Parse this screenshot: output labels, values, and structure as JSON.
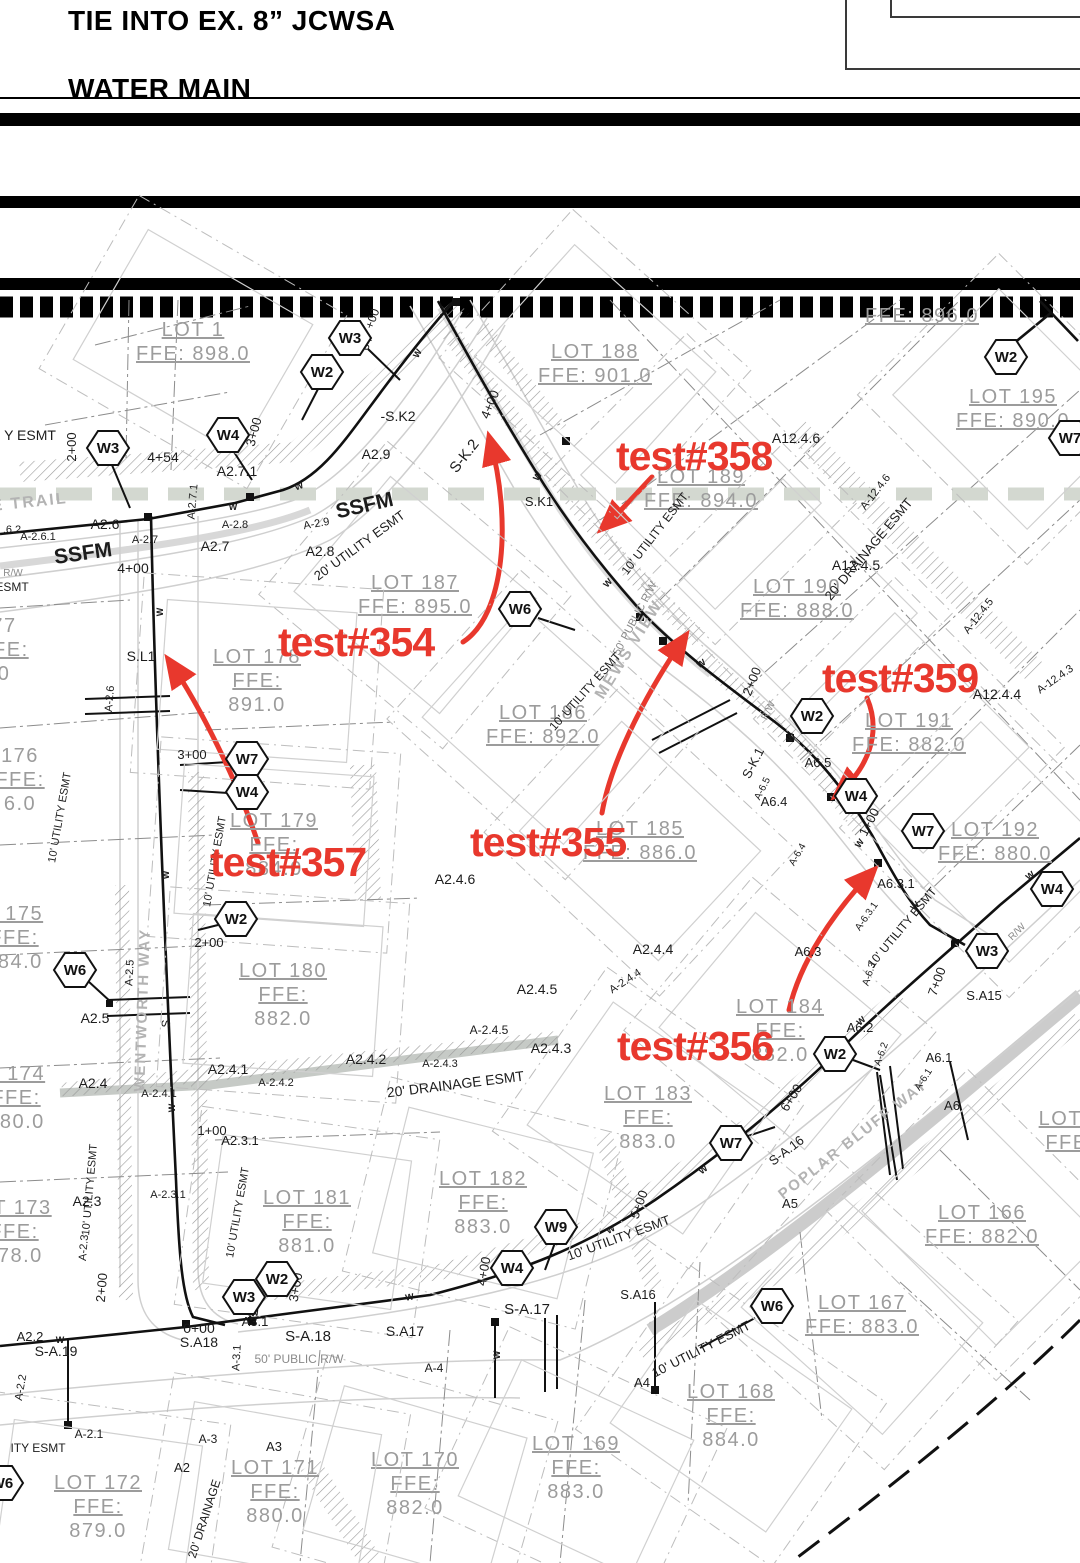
{
  "header": {
    "line1": "TIE INTO EX. 8” JCWSA",
    "line2": "WATER MAIN"
  },
  "colors": {
    "red": "#e8382d",
    "lot": "#9c9c9c",
    "street": "#b3b3b3",
    "rw": "#8a8a8a",
    "ink": "#1c1c1c",
    "band": "#d3d8d0"
  },
  "annotations": [
    {
      "label": "test#354",
      "x": 278,
      "y": 656
    },
    {
      "label": "test#355",
      "x": 470,
      "y": 856
    },
    {
      "label": "test#356",
      "x": 617,
      "y": 1060
    },
    {
      "label": "test#357",
      "x": 210,
      "y": 876
    },
    {
      "label": "test#358",
      "x": 616,
      "y": 470
    },
    {
      "label": "test#359",
      "x": 822,
      "y": 692
    }
  ],
  "hexes": [
    {
      "label": "W3",
      "x": 350,
      "y": 338
    },
    {
      "label": "W2",
      "x": 322,
      "y": 372
    },
    {
      "label": "W2",
      "x": 1006,
      "y": 357
    },
    {
      "label": "W7",
      "x": 1070,
      "y": 438
    },
    {
      "label": "W3",
      "x": 108,
      "y": 448
    },
    {
      "label": "W4",
      "x": 228,
      "y": 435
    },
    {
      "label": "W6",
      "x": 520,
      "y": 609
    },
    {
      "label": "W2",
      "x": 812,
      "y": 716
    },
    {
      "label": "W7",
      "x": 247,
      "y": 759
    },
    {
      "label": "W4",
      "x": 247,
      "y": 792
    },
    {
      "label": "W4",
      "x": 856,
      "y": 796
    },
    {
      "label": "W7",
      "x": 923,
      "y": 831
    },
    {
      "label": "W2",
      "x": 236,
      "y": 919
    },
    {
      "label": "W6",
      "x": 75,
      "y": 970
    },
    {
      "label": "W2",
      "x": 835,
      "y": 1054
    },
    {
      "label": "W4",
      "x": 1052,
      "y": 889
    },
    {
      "label": "W3",
      "x": 987,
      "y": 951
    },
    {
      "label": "W7",
      "x": 731,
      "y": 1143
    },
    {
      "label": "W9",
      "x": 556,
      "y": 1227
    },
    {
      "label": "W2",
      "x": 277,
      "y": 1279
    },
    {
      "label": "W3",
      "x": 244,
      "y": 1297
    },
    {
      "label": "W4",
      "x": 512,
      "y": 1268
    },
    {
      "label": "W6",
      "x": 772,
      "y": 1306
    },
    {
      "label": "W6",
      "x": 2,
      "y": 1483
    }
  ],
  "lots": [
    {
      "x": 193,
      "y": 336,
      "rot": 30,
      "d": 1,
      "lines": [
        "LOT 1",
        "FFE: 898.0"
      ]
    },
    {
      "x": 595,
      "y": 358,
      "rot": 42,
      "d": 1,
      "lines": [
        "LOT 188",
        "FFE: 901.0"
      ]
    },
    {
      "x": 922,
      "y": 322,
      "rot": 45,
      "d": 0,
      "lines": [
        "FFE: 896.0"
      ]
    },
    {
      "x": 1013,
      "y": 403,
      "rot": 45,
      "d": 1,
      "lines": [
        "LOT 195",
        "FFE: 890.0"
      ]
    },
    {
      "x": 701,
      "y": 483,
      "rot": 45,
      "d": 1,
      "lines": [
        "LOT 189",
        "FFE: 894.0"
      ]
    },
    {
      "x": 415,
      "y": 589,
      "rot": 40,
      "d": 1,
      "lines": [
        "LOT 187",
        "FFE: 895.0"
      ]
    },
    {
      "x": 797,
      "y": 593,
      "rot": 45,
      "d": 1,
      "lines": [
        "LOT 190",
        "FFE: 888.0"
      ]
    },
    {
      "x": 257,
      "y": 663,
      "rot": 4,
      "d": 1,
      "lines": [
        "LOT 178",
        "FFE:",
        "891.0"
      ]
    },
    {
      "x": 4,
      "y": 632,
      "rot": 0,
      "d": 0,
      "lines": [
        "77",
        "FFE:",
        "0"
      ]
    },
    {
      "x": 543,
      "y": 719,
      "rot": 42,
      "d": 1,
      "lines": [
        "LOT 186",
        "FFE: 892.0"
      ]
    },
    {
      "x": 20,
      "y": 762,
      "rot": 0,
      "d": 0,
      "lines": [
        "176",
        "FFE:",
        "6.0"
      ]
    },
    {
      "x": 274,
      "y": 827,
      "rot": 4,
      "d": 1,
      "lines": [
        "LOT 179",
        "FFE:",
        "884.0"
      ]
    },
    {
      "x": 640,
      "y": 835,
      "rot": 43,
      "d": 1,
      "lines": [
        "LOT 185",
        "FFE: 886.0"
      ]
    },
    {
      "x": 909,
      "y": 727,
      "rot": 45,
      "d": 1,
      "lines": [
        "LOT 191",
        "FFE: 882.0"
      ]
    },
    {
      "x": 995,
      "y": 836,
      "rot": 45,
      "d": 1,
      "lines": [
        "LOT 192",
        "FFE: 880.0"
      ]
    },
    {
      "x": 14,
      "y": 920,
      "rot": 0,
      "d": 0,
      "lines": [
        "T 175",
        "FFE:",
        "884.0"
      ]
    },
    {
      "x": 283,
      "y": 977,
      "rot": 4,
      "d": 1,
      "lines": [
        "LOT 180",
        "FFE:",
        "882.0"
      ]
    },
    {
      "x": 780,
      "y": 1013,
      "rot": 40,
      "d": 1,
      "lines": [
        "LOT 184",
        "FFE:",
        "882.0"
      ]
    },
    {
      "x": 16,
      "y": 1080,
      "rot": 0,
      "d": 0,
      "lines": [
        "T 174",
        "FFE:",
        "880.0"
      ]
    },
    {
      "x": 648,
      "y": 1100,
      "rot": 35,
      "d": 1,
      "lines": [
        "LOT 183",
        "FFE:",
        "883.0"
      ]
    },
    {
      "x": 14,
      "y": 1214,
      "rot": 0,
      "d": 0,
      "lines": [
        "OT 173",
        "FFE:",
        "878.0"
      ]
    },
    {
      "x": 307,
      "y": 1204,
      "rot": 8,
      "d": 1,
      "lines": [
        "LOT 181",
        "FFE:",
        "881.0"
      ]
    },
    {
      "x": 483,
      "y": 1185,
      "rot": 14,
      "d": 1,
      "lines": [
        "LOT 182",
        "FFE:",
        "883.0"
      ]
    },
    {
      "x": 982,
      "y": 1219,
      "rot": 45,
      "d": 1,
      "lines": [
        "LOT 166",
        "FFE: 882.0"
      ]
    },
    {
      "x": 862,
      "y": 1309,
      "rot": 42,
      "d": 1,
      "lines": [
        "LOT 167",
        "FFE: 883.0"
      ]
    },
    {
      "x": 731,
      "y": 1398,
      "rot": 35,
      "d": 1,
      "lines": [
        "LOT 168",
        "FFE:",
        "884.0"
      ]
    },
    {
      "x": 576,
      "y": 1450,
      "rot": 25,
      "d": 1,
      "lines": [
        "LOT 169",
        "FFE:",
        "883.0"
      ]
    },
    {
      "x": 415,
      "y": 1466,
      "rot": 16,
      "d": 1,
      "lines": [
        "LOT 170",
        "FFE:",
        "882.0"
      ]
    },
    {
      "x": 275,
      "y": 1474,
      "rot": 10,
      "d": 1,
      "lines": [
        "LOT 171",
        "FFE:",
        "880.0"
      ]
    },
    {
      "x": 98,
      "y": 1489,
      "rot": 8,
      "d": 1,
      "lines": [
        "LOT 172",
        "FFE:",
        "879.0"
      ]
    },
    {
      "x": 1070,
      "y": 1125,
      "rot": 0,
      "d": 0,
      "lines": [
        "LOT 1",
        "FFE:"
      ]
    }
  ],
  "labels": [
    {
      "t": "Y ESMT",
      "x": 30,
      "y": 440,
      "s": 14
    },
    {
      "t": "2+00",
      "x": 76,
      "y": 447,
      "r": -90,
      "s": 13
    },
    {
      "t": "4+54",
      "x": 163,
      "y": 462,
      "s": 14
    },
    {
      "t": "A2.7.1",
      "x": 237,
      "y": 476,
      "s": 14
    },
    {
      "t": "3+00",
      "x": 258,
      "y": 433,
      "r": -75,
      "s": 13
    },
    {
      "t": "+00",
      "x": 376,
      "y": 320,
      "r": -70,
      "s": 12
    },
    {
      "t": "64",
      "x": 370,
      "y": 345,
      "r": -70,
      "s": 12
    },
    {
      "t": "-S.K2",
      "x": 398,
      "y": 421,
      "s": 14
    },
    {
      "t": "A2.9",
      "x": 376,
      "y": 459,
      "s": 14
    },
    {
      "t": "S-K.2",
      "x": 468,
      "y": 459,
      "r": -52,
      "s": 15
    },
    {
      "t": "4+00",
      "x": 494,
      "y": 406,
      "r": -68,
      "s": 13
    },
    {
      "t": "S.K1",
      "x": 539,
      "y": 506,
      "s": 13
    },
    {
      "t": "SSFM",
      "x": 366,
      "y": 512,
      "r": -13,
      "s": 21,
      "w": 700
    },
    {
      "t": "SSFM",
      "x": 84,
      "y": 560,
      "r": -8,
      "s": 21,
      "w": 700
    },
    {
      "t": "A-2.9",
      "x": 317,
      "y": 527,
      "r": -10,
      "s": 11
    },
    {
      "t": "A2.8",
      "x": 320,
      "y": 556,
      "s": 14
    },
    {
      "t": "20' UTILITY ESMT",
      "x": 362,
      "y": 549,
      "r": -36,
      "s": 13
    },
    {
      "t": "A2.6",
      "x": 105,
      "y": 529,
      "s": 14
    },
    {
      "t": ".6.2",
      "x": 12,
      "y": 533,
      "s": 11
    },
    {
      "t": "A-2.6.1",
      "x": 38,
      "y": 540,
      "s": 11
    },
    {
      "t": "A-2.7",
      "x": 145,
      "y": 543,
      "s": 11
    },
    {
      "t": "A2.7",
      "x": 215,
      "y": 551,
      "s": 14
    },
    {
      "t": "A-2.8",
      "x": 235,
      "y": 528,
      "s": 11
    },
    {
      "t": "E TRAIL",
      "x": 30,
      "y": 507,
      "r": -6,
      "s": 16,
      "c": "street",
      "w": 700
    },
    {
      "t": "R/W",
      "x": 13,
      "y": 576,
      "s": 10,
      "c": "rw"
    },
    {
      "t": "ESMT",
      "x": 12,
      "y": 591,
      "s": 12
    },
    {
      "t": "4+00",
      "x": 133,
      "y": 573,
      "s": 14
    },
    {
      "t": "A-2.7.1",
      "x": 196,
      "y": 502,
      "r": -85,
      "s": 11
    },
    {
      "t": "S.L1",
      "x": 141,
      "y": 661,
      "s": 14
    },
    {
      "t": "A-2.6",
      "x": 113,
      "y": 699,
      "r": -85,
      "s": 11
    },
    {
      "t": "3+00",
      "x": 192,
      "y": 759,
      "s": 13
    },
    {
      "t": "10' UTILITY ESMT",
      "x": 63,
      "y": 818,
      "r": -80,
      "s": 11
    },
    {
      "t": "10' UTILITY ESMT",
      "x": 218,
      "y": 862,
      "r": -80,
      "s": 11
    },
    {
      "t": "A2.4.6",
      "x": 455,
      "y": 884,
      "s": 14
    },
    {
      "t": "A2.5",
      "x": 95,
      "y": 1023,
      "s": 14
    },
    {
      "t": "A-2.5",
      "x": 133,
      "y": 973,
      "r": -87,
      "s": 11
    },
    {
      "t": "2+00",
      "x": 209,
      "y": 947,
      "s": 13
    },
    {
      "t": "MEWS VIEW",
      "x": 633,
      "y": 652,
      "r": -58,
      "s": 16,
      "c": "street",
      "w": 700
    },
    {
      "t": "50' PUBLIC R/W",
      "x": 638,
      "y": 620,
      "r": -62,
      "s": 11,
      "c": "rw"
    },
    {
      "t": "10' UTILITY ESMT",
      "x": 588,
      "y": 694,
      "r": -48,
      "s": 12
    },
    {
      "t": "10' UTILITY ESMT",
      "x": 658,
      "y": 536,
      "r": -52,
      "s": 12
    },
    {
      "t": "2+00",
      "x": 756,
      "y": 683,
      "r": -68,
      "s": 13
    },
    {
      "t": "S-K.1",
      "x": 757,
      "y": 765,
      "r": -63,
      "s": 13
    },
    {
      "t": "A-6.5",
      "x": 765,
      "y": 790,
      "r": -63,
      "s": 10
    },
    {
      "t": "A6.4",
      "x": 774,
      "y": 806,
      "s": 13
    },
    {
      "t": "R/W",
      "x": 771,
      "y": 712,
      "r": -63,
      "s": 10,
      "c": "rw"
    },
    {
      "t": "A6.5",
      "x": 818,
      "y": 767,
      "s": 13
    },
    {
      "t": "1+00",
      "x": 873,
      "y": 824,
      "r": -63,
      "s": 13
    },
    {
      "t": "A-6.4",
      "x": 800,
      "y": 856,
      "r": -60,
      "s": 10
    },
    {
      "t": "A12.4.6",
      "x": 796,
      "y": 443,
      "s": 14
    },
    {
      "t": "A-12.4.6",
      "x": 878,
      "y": 494,
      "r": -52,
      "s": 11
    },
    {
      "t": "20' DRAINAGE ESMT",
      "x": 872,
      "y": 552,
      "r": -50,
      "s": 13
    },
    {
      "t": "A12.4.5",
      "x": 856,
      "y": 570,
      "s": 14
    },
    {
      "t": "A-12.4.5",
      "x": 981,
      "y": 618,
      "r": -52,
      "s": 11
    },
    {
      "t": "A12.4.4",
      "x": 997,
      "y": 699,
      "s": 14
    },
    {
      "t": "A-12.4.3",
      "x": 1057,
      "y": 682,
      "r": -35,
      "s": 11
    },
    {
      "t": "A6.3.1",
      "x": 896,
      "y": 888,
      "s": 13
    },
    {
      "t": "A-6.3.1",
      "x": 869,
      "y": 918,
      "r": -55,
      "s": 10
    },
    {
      "t": "10' UTILITY ESMT",
      "x": 905,
      "y": 930,
      "r": -50,
      "s": 12
    },
    {
      "t": "R/W",
      "x": 1019,
      "y": 934,
      "r": -45,
      "s": 10,
      "c": "rw"
    },
    {
      "t": "7+00",
      "x": 941,
      "y": 983,
      "r": -70,
      "s": 13
    },
    {
      "t": "S.A15",
      "x": 984,
      "y": 1000,
      "s": 13
    },
    {
      "t": "A-6.3",
      "x": 872,
      "y": 975,
      "r": -72,
      "s": 10
    },
    {
      "t": "A6.2",
      "x": 860,
      "y": 1032,
      "s": 13
    },
    {
      "t": "A-6.2",
      "x": 884,
      "y": 1055,
      "r": -70,
      "s": 10
    },
    {
      "t": "A6.3",
      "x": 808,
      "y": 956,
      "s": 13
    },
    {
      "t": "A2.4.4",
      "x": 653,
      "y": 954,
      "s": 14
    },
    {
      "t": "A-2.4.4",
      "x": 627,
      "y": 984,
      "r": -33,
      "s": 11
    },
    {
      "t": "A2.4.5",
      "x": 537,
      "y": 994,
      "s": 14
    },
    {
      "t": "A-2.4.5",
      "x": 489,
      "y": 1034,
      "s": 12
    },
    {
      "t": "A2.4.3",
      "x": 551,
      "y": 1053,
      "s": 14
    },
    {
      "t": "A2.4.2",
      "x": 366,
      "y": 1064,
      "s": 14
    },
    {
      "t": "A-2.4.3",
      "x": 440,
      "y": 1067,
      "s": 11
    },
    {
      "t": "A2.4.1",
      "x": 228,
      "y": 1074,
      "s": 14
    },
    {
      "t": "A-2.4.1",
      "x": 159,
      "y": 1097,
      "s": 11
    },
    {
      "t": "A-2.4.2",
      "x": 276,
      "y": 1086,
      "s": 11
    },
    {
      "t": "A2.4",
      "x": 93,
      "y": 1088,
      "s": 14
    },
    {
      "t": "20' DRAINAGE ESMT",
      "x": 456,
      "y": 1089,
      "r": -7,
      "s": 14
    },
    {
      "t": "WENTWORTH WAY",
      "x": 147,
      "y": 1010,
      "r": -88,
      "s": 15,
      "c": "street",
      "w": 700
    },
    {
      "t": "S",
      "x": 170,
      "y": 1024,
      "r": -85,
      "s": 12
    },
    {
      "t": "6+00",
      "x": 795,
      "y": 1100,
      "r": -58,
      "s": 13
    },
    {
      "t": "POPLAR BLUFF WAY",
      "x": 856,
      "y": 1143,
      "r": -38,
      "s": 15,
      "c": "street",
      "w": 700
    },
    {
      "t": "A6.1",
      "x": 939,
      "y": 1062,
      "s": 13
    },
    {
      "t": "A-6.1",
      "x": 926,
      "y": 1081,
      "r": -58,
      "s": 10
    },
    {
      "t": "A6",
      "x": 952,
      "y": 1110,
      "s": 13
    },
    {
      "t": "A5",
      "x": 790,
      "y": 1208,
      "s": 13
    },
    {
      "t": "S-A.16",
      "x": 789,
      "y": 1154,
      "r": -37,
      "s": 13
    },
    {
      "t": "5+00",
      "x": 643,
      "y": 1206,
      "r": -70,
      "s": 13
    },
    {
      "t": "10' UTILITY ESMT",
      "x": 620,
      "y": 1242,
      "r": -20,
      "s": 13
    },
    {
      "t": "S.A16",
      "x": 638,
      "y": 1299,
      "s": 13
    },
    {
      "t": "A4",
      "x": 642,
      "y": 1387,
      "s": 13
    },
    {
      "t": "10' UTILITY ESMT",
      "x": 703,
      "y": 1353,
      "r": -27,
      "s": 13
    },
    {
      "t": "1+00",
      "x": 212,
      "y": 1135,
      "s": 13
    },
    {
      "t": "A2.3.1",
      "x": 240,
      "y": 1145,
      "s": 13
    },
    {
      "t": "A-2.3.1",
      "x": 168,
      "y": 1198,
      "s": 11
    },
    {
      "t": "10' UTILITY ESMT",
      "x": 241,
      "y": 1213,
      "r": -80,
      "s": 11
    },
    {
      "t": "10' UTILITY ESMT",
      "x": 93,
      "y": 1190,
      "r": -85,
      "s": 11
    },
    {
      "t": "A2.3",
      "x": 87,
      "y": 1206,
      "s": 14
    },
    {
      "t": "A-2.3",
      "x": 87,
      "y": 1248,
      "r": -85,
      "s": 11
    },
    {
      "t": "2+00",
      "x": 106,
      "y": 1288,
      "r": -85,
      "s": 13
    },
    {
      "t": "3+00",
      "x": 300,
      "y": 1288,
      "r": -80,
      "s": 13
    },
    {
      "t": "4+00",
      "x": 488,
      "y": 1272,
      "r": -80,
      "s": 13
    },
    {
      "t": "0+00",
      "x": 199,
      "y": 1333,
      "s": 14
    },
    {
      "t": "S.A18",
      "x": 199,
      "y": 1347,
      "s": 14
    },
    {
      "t": "A3.1",
      "x": 255,
      "y": 1326,
      "s": 13
    },
    {
      "t": "A-3.1",
      "x": 240,
      "y": 1358,
      "r": -87,
      "s": 11
    },
    {
      "t": "S-A.18",
      "x": 308,
      "y": 1341,
      "s": 15
    },
    {
      "t": "S.A17",
      "x": 405,
      "y": 1336,
      "s": 14
    },
    {
      "t": "S-A.17",
      "x": 527,
      "y": 1314,
      "s": 15
    },
    {
      "t": "50' PUBLIC R/W",
      "x": 299,
      "y": 1363,
      "s": 12,
      "c": "rw"
    },
    {
      "t": "A-4",
      "x": 434,
      "y": 1372,
      "s": 12
    },
    {
      "t": "A2.2",
      "x": 30,
      "y": 1341,
      "s": 13
    },
    {
      "t": "S-A.19",
      "x": 56,
      "y": 1356,
      "s": 14
    },
    {
      "t": "A-2.2",
      "x": 24,
      "y": 1388,
      "r": -80,
      "s": 11
    },
    {
      "t": "A-2.1",
      "x": 89,
      "y": 1438,
      "s": 12
    },
    {
      "t": "A-3",
      "x": 208,
      "y": 1443,
      "s": 12
    },
    {
      "t": "A3",
      "x": 274,
      "y": 1451,
      "s": 13
    },
    {
      "t": "A2",
      "x": 182,
      "y": 1472,
      "s": 13
    },
    {
      "t": "ITY ESMT",
      "x": 38,
      "y": 1452,
      "s": 12
    },
    {
      "t": "20' DRAINAGE",
      "x": 208,
      "y": 1520,
      "r": -72,
      "s": 12
    },
    {
      "t": "W",
      "x": 233,
      "y": 510,
      "s": 9,
      "w": 700
    },
    {
      "t": "W",
      "x": 300,
      "y": 489,
      "r": -20,
      "s": 9,
      "w": 700
    },
    {
      "t": "W",
      "x": 420,
      "y": 355,
      "r": -60,
      "s": 9,
      "w": 700
    },
    {
      "t": "W",
      "x": 540,
      "y": 478,
      "r": -55,
      "s": 9,
      "w": 700
    },
    {
      "t": "W",
      "x": 610,
      "y": 585,
      "r": -48,
      "s": 9,
      "w": 700
    },
    {
      "t": "W",
      "x": 703,
      "y": 666,
      "r": -35,
      "s": 9,
      "w": 700
    },
    {
      "t": "W",
      "x": 793,
      "y": 740,
      "r": -42,
      "s": 9,
      "w": 700
    },
    {
      "t": "W",
      "x": 862,
      "y": 845,
      "r": -55,
      "s": 9,
      "w": 700
    },
    {
      "t": "W",
      "x": 917,
      "y": 908,
      "r": -45,
      "s": 9,
      "w": 700
    },
    {
      "t": "W",
      "x": 163,
      "y": 612,
      "r": -90,
      "s": 9,
      "w": 700
    },
    {
      "t": "W",
      "x": 169,
      "y": 875,
      "r": -90,
      "s": 9,
      "w": 700
    },
    {
      "t": "W",
      "x": 175,
      "y": 1108,
      "r": -90,
      "s": 9,
      "w": 700
    },
    {
      "t": "W",
      "x": 255,
      "y": 1316,
      "r": -8,
      "s": 9,
      "w": 700
    },
    {
      "t": "W",
      "x": 410,
      "y": 1300,
      "r": -10,
      "s": 9,
      "w": 700
    },
    {
      "t": "W",
      "x": 612,
      "y": 1232,
      "r": -30,
      "s": 9,
      "w": 700
    },
    {
      "t": "W",
      "x": 705,
      "y": 1172,
      "r": -38,
      "s": 9,
      "w": 700
    },
    {
      "t": "W",
      "x": 863,
      "y": 1023,
      "r": -42,
      "s": 9,
      "w": 700
    },
    {
      "t": "W",
      "x": 1032,
      "y": 878,
      "r": -38,
      "s": 9,
      "w": 700
    },
    {
      "t": "W",
      "x": 60,
      "y": 1343,
      "s": 9,
      "w": 700
    },
    {
      "t": "W",
      "x": 500,
      "y": 1355,
      "r": -90,
      "s": 9,
      "w": 700
    }
  ]
}
